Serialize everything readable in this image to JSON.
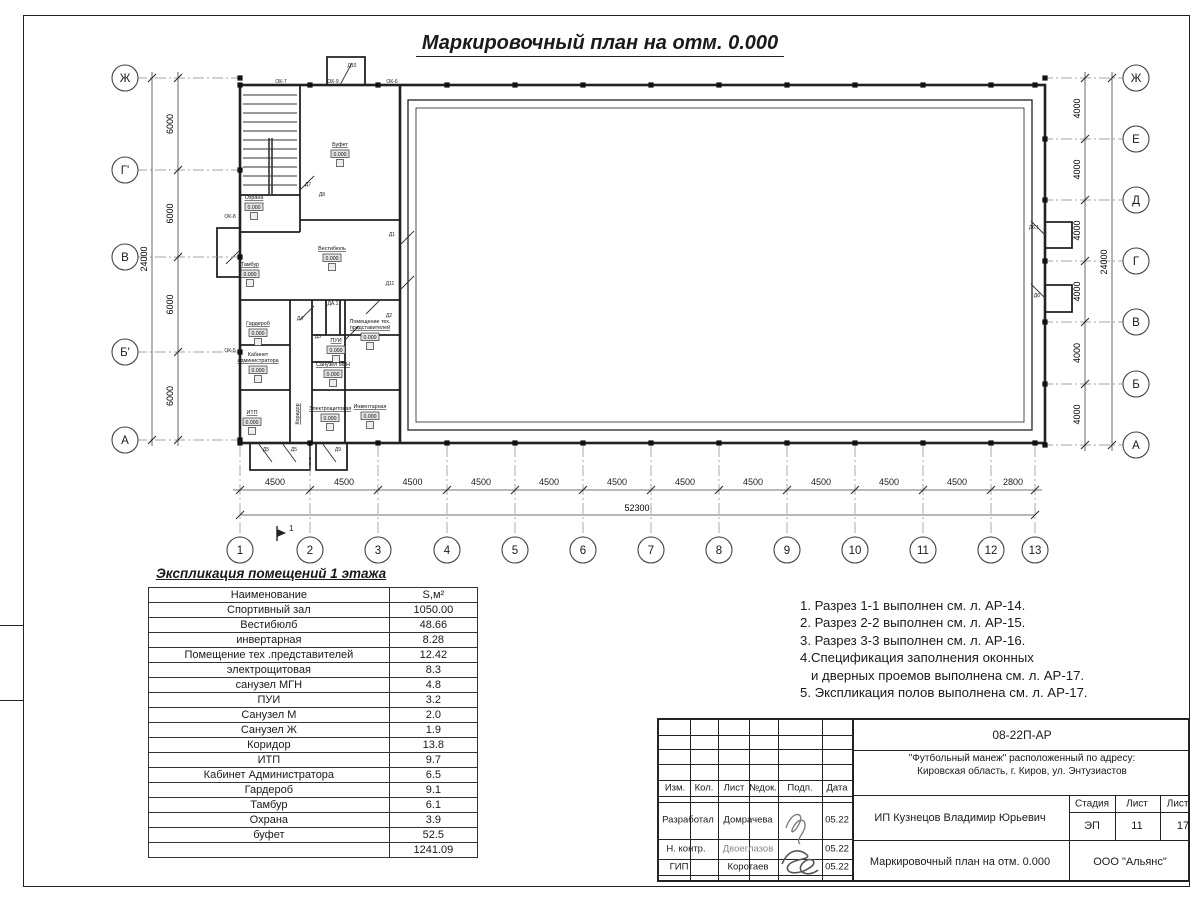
{
  "sheet": {
    "title": "Маркировочный план на отм. 0.000"
  },
  "plan": {
    "axes_left": [
      "Ж",
      "Г'",
      "В",
      "Б'",
      "А"
    ],
    "axes_right": [
      "Ж",
      "Е",
      "Д",
      "Г",
      "В",
      "Б",
      "А"
    ],
    "axes_bottom": [
      "1",
      "2",
      "3",
      "4",
      "5",
      "6",
      "7",
      "8",
      "9",
      "10",
      "11",
      "12",
      "13"
    ],
    "dims_left": {
      "segments": [
        "6000",
        "6000",
        "6000",
        "6000"
      ],
      "total": "24000"
    },
    "dims_right": {
      "segments": [
        "4000",
        "4000",
        "4000",
        "4000",
        "4000",
        "4000"
      ],
      "total": "24000"
    },
    "dims_bottom": {
      "segments": [
        "4500",
        "4500",
        "4500",
        "4500",
        "4500",
        "4500",
        "4500",
        "4500",
        "4500",
        "4500",
        "4500",
        "2800"
      ],
      "total": "52300"
    },
    "elevation_mark": "0.000",
    "section_mark": "1",
    "rooms": [
      {
        "lines": [
          "Буфет"
        ],
        "x": 340,
        "y": 146
      },
      {
        "lines": [
          "Охрана"
        ],
        "x": 254,
        "y": 199
      },
      {
        "lines": [
          "Вестибюль"
        ],
        "x": 332,
        "y": 250
      },
      {
        "lines": [
          "Тамбур"
        ],
        "x": 250,
        "y": 266
      },
      {
        "lines": [
          "Гардероб"
        ],
        "x": 258,
        "y": 325
      },
      {
        "lines": [
          "Кабинет",
          "администратора"
        ],
        "x": 258,
        "y": 356
      },
      {
        "lines": [
          "ИТП"
        ],
        "x": 252,
        "y": 414
      },
      {
        "lines": [
          "Коридор"
        ],
        "x": 299,
        "y": 414,
        "vertical": true,
        "nobox": true
      },
      {
        "lines": [
          "Электрощитовая"
        ],
        "x": 330,
        "y": 410
      },
      {
        "lines": [
          "Санузел МГН"
        ],
        "x": 333,
        "y": 366
      },
      {
        "lines": [
          "ПУИ"
        ],
        "x": 336,
        "y": 342
      },
      {
        "lines": [
          "Помещение тех.",
          "представителей"
        ],
        "x": 370,
        "y": 323
      },
      {
        "lines": [
          "Инвентарная"
        ],
        "x": 370,
        "y": 408
      }
    ],
    "openings": [
      {
        "t": "ОК-7",
        "x": 281,
        "y": 83
      },
      {
        "t": "ОК-9",
        "x": 333,
        "y": 83
      },
      {
        "t": "Д10",
        "x": 352,
        "y": 67
      },
      {
        "t": "ОК-6",
        "x": 392,
        "y": 83
      },
      {
        "t": "ОК-8",
        "x": 230,
        "y": 218
      },
      {
        "t": "ОК-5",
        "x": 230,
        "y": 352
      },
      {
        "t": "Д7",
        "x": 308,
        "y": 186
      },
      {
        "t": "Д8",
        "x": 322,
        "y": 196
      },
      {
        "t": "Д1",
        "x": 392,
        "y": 236
      },
      {
        "t": "Д11",
        "x": 390,
        "y": 285
      },
      {
        "t": "ДА.1",
        "x": 333,
        "y": 305
      },
      {
        "t": "Д4",
        "x": 300,
        "y": 320
      },
      {
        "t": "Д3",
        "x": 318,
        "y": 338
      },
      {
        "t": "Д2",
        "x": 389,
        "y": 317
      },
      {
        "t": "Д6.1",
        "x": 1034,
        "y": 229
      },
      {
        "t": "Д6",
        "x": 1037,
        "y": 297
      },
      {
        "t": "Д5",
        "x": 266,
        "y": 451
      },
      {
        "t": "Д5",
        "x": 294,
        "y": 451
      },
      {
        "t": "Д9",
        "x": 338,
        "y": 451
      }
    ]
  },
  "schedule": {
    "title": "Экспликация помещений 1 этажа",
    "headers": [
      "Наименование",
      "S,м²"
    ],
    "rows": [
      [
        "Спортивный зал",
        "1050.00"
      ],
      [
        "Вестибюлб",
        "48.66"
      ],
      [
        "инвертарная",
        "8.28"
      ],
      [
        "Помещение тех .представителей",
        "12.42"
      ],
      [
        "электрощитовая",
        "8.3"
      ],
      [
        "санузел МГН",
        "4.8"
      ],
      [
        "ПУИ",
        "3.2"
      ],
      [
        "Санузел М",
        "2.0"
      ],
      [
        "Санузел Ж",
        "1.9"
      ],
      [
        "Коридор",
        "13.8"
      ],
      [
        "ИТП",
        "9.7"
      ],
      [
        "Кабинет Администратора",
        "6.5"
      ],
      [
        "Гардероб",
        "9.1"
      ],
      [
        "Тамбур",
        "6.1"
      ],
      [
        "Охрана",
        "3.9"
      ],
      [
        "буфет",
        "52.5"
      ]
    ],
    "total": "1241.09"
  },
  "notes": [
    "1. Разрез 1-1 выполнен см. л. АР-14.",
    "2. Разрез 2-2 выполнен см. л. АР-15.",
    "3. Разрез 3-3 выполнен см. л. АР-16.",
    "4.Спецификация заполнения оконных",
    "   и дверных проемов выполнена см. л. АР-17.",
    "5. Экспликация полов выполнена см. л. АР-17."
  ],
  "titleblock": {
    "code": "08-22П-АР",
    "project_line1": "\"Футбольный манеж\" расположенный по адресу:",
    "project_line2": "Кировская область, г. Киров, ул. Энтузиастов",
    "client": "ИП Кузнецов Владимир Юрьевич",
    "doc_title": "Маркировочный план на отм. 0.000",
    "company": "ООО \"Альянс\"",
    "stage_label": "Стадия",
    "stage_value": "ЭП",
    "sheet_label": "Лист",
    "sheet_value": "11",
    "sheets_label": "Листов",
    "sheets_value": "17",
    "cols": [
      "Изм.",
      "Кол.",
      "Лист",
      "№док.",
      "Подп.",
      "Дата"
    ],
    "people": [
      {
        "role": "Разработал",
        "name": "Домрачева",
        "date": "05.22"
      },
      {
        "role": "Н. контр.",
        "name": "Двоеглазов",
        "date": "05.22"
      },
      {
        "role": "ГИП",
        "name": "Коротаев",
        "date": "05.22"
      }
    ]
  }
}
